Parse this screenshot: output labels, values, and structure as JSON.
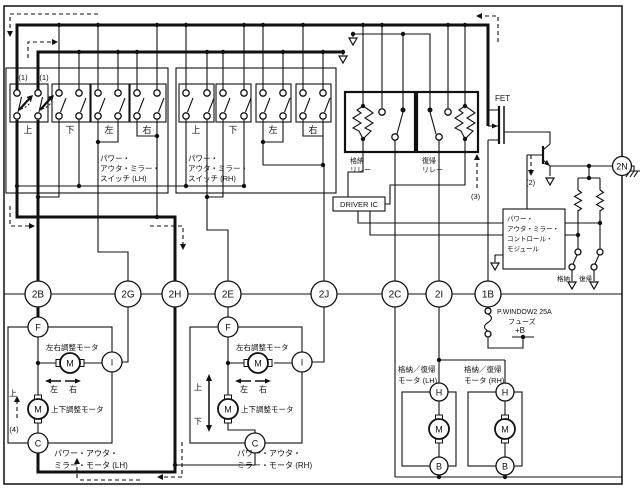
{
  "colors": {
    "line": "#111111",
    "bg": "#ffffff"
  },
  "ann": {
    "one": "(1)",
    "two": "(2)",
    "three": "(3)",
    "four": "(4)"
  },
  "sw_lh": {
    "l1": "パワー・",
    "l2": "アウタ・ミラー・",
    "l3": "スイッチ (LH)",
    "g": [
      "上",
      "下",
      "左",
      "右"
    ]
  },
  "sw_rh": {
    "l1": "パワー・",
    "l2": "アウタ・ミラー・",
    "l3": "スイッチ (RH)",
    "g": [
      "上",
      "下",
      "左",
      "右"
    ]
  },
  "relay_st": {
    "l1": "格納",
    "l2": "リレー"
  },
  "relay_rt": {
    "l1": "復帰",
    "l2": "リレー"
  },
  "fet": "FET",
  "driver": "DRIVER IC",
  "module": {
    "l1": "パワー・",
    "l2": "アウタ・ミラー・",
    "l3": "コントロール・",
    "l4": "モジュール"
  },
  "msw": {
    "st": "格納",
    "rt": "復帰"
  },
  "conn": {
    "b2": "2B",
    "g2": "2G",
    "h2": "2H",
    "e2": "2E",
    "j2": "2J",
    "c2": "2C",
    "i2": "2I",
    "b1": "1B",
    "n2": "2N"
  },
  "fuse": {
    "name": "P.WINDOW2 25A",
    "type": "フューズ",
    "term": "+B"
  },
  "mlh": {
    "f": "F",
    "i": "I",
    "c": "C",
    "m": "M",
    "lr": "左右調整モータ",
    "ud": "上下調整モータ",
    "lt": "左",
    "rt": "右",
    "up": "上",
    "n1": "パワー・アウタ・",
    "n2": "ミラー・モータ (LH)"
  },
  "mrh": {
    "f": "F",
    "i": "I",
    "c": "C",
    "m": "M",
    "lr": "左右調整モータ",
    "ud": "上下調整モータ",
    "lt": "左",
    "rt": "右",
    "up": "上",
    "dn": "下",
    "n1": "パワー・アウタ・",
    "n2": "ミラー・モータ (RH)"
  },
  "flh": {
    "h": "H",
    "m": "M",
    "b": "B",
    "n1": "格納／復帰",
    "n2": "モータ (LH)"
  },
  "frh": {
    "h": "H",
    "m": "M",
    "b": "B",
    "n1": "格納／復帰",
    "n2": "モータ (RH)"
  }
}
